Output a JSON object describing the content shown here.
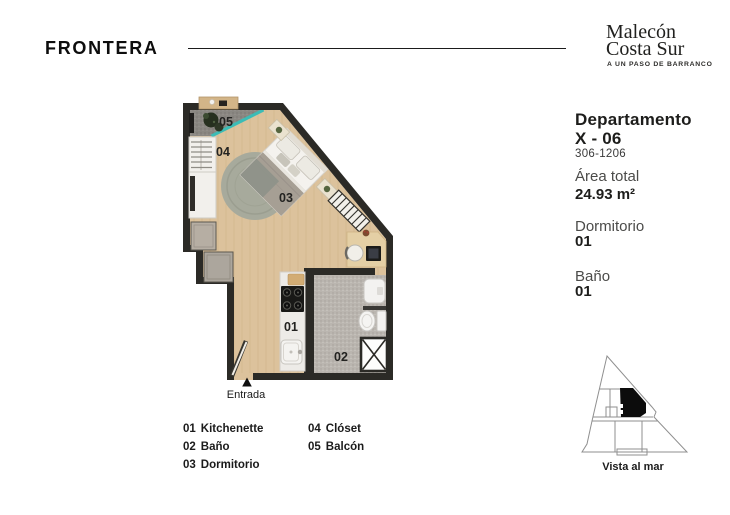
{
  "brand": {
    "logo": "FRONTERA",
    "project_line1": "Malecón",
    "project_line2": "Costa Sur",
    "tagline": "A UN PASO DE BARRANCO"
  },
  "unit": {
    "title_line1": "Departamento",
    "title_line2": "X - 06",
    "units_range": "306-1206",
    "area_label": "Área total",
    "area_value": "24.93 m²",
    "bedrooms_label": "Dormitorio",
    "bedrooms_value": "01",
    "bathrooms_label": "Baño",
    "bathrooms_value": "01"
  },
  "plan": {
    "room_labels": {
      "kitchenette": "01",
      "bath": "02",
      "bedroom": "03",
      "closet": "04",
      "balcony": "05"
    },
    "entrance": "Entrada"
  },
  "legend": {
    "col1": [
      {
        "num": "01",
        "name": "Kitchenette"
      },
      {
        "num": "02",
        "name": "Baño"
      },
      {
        "num": "03",
        "name": "Dormitorio"
      }
    ],
    "col2": [
      {
        "num": "04",
        "name": "Clóset"
      },
      {
        "num": "05",
        "name": "Balcón"
      }
    ]
  },
  "key_plan": {
    "caption": "Vista al mar"
  },
  "colors": {
    "wall": "#2B2A26",
    "wood": "#DCC29C",
    "glass_teal": "#3CBCB6",
    "balcony_floor": "#8A8782",
    "bath_floor": "#BAB5AF"
  }
}
